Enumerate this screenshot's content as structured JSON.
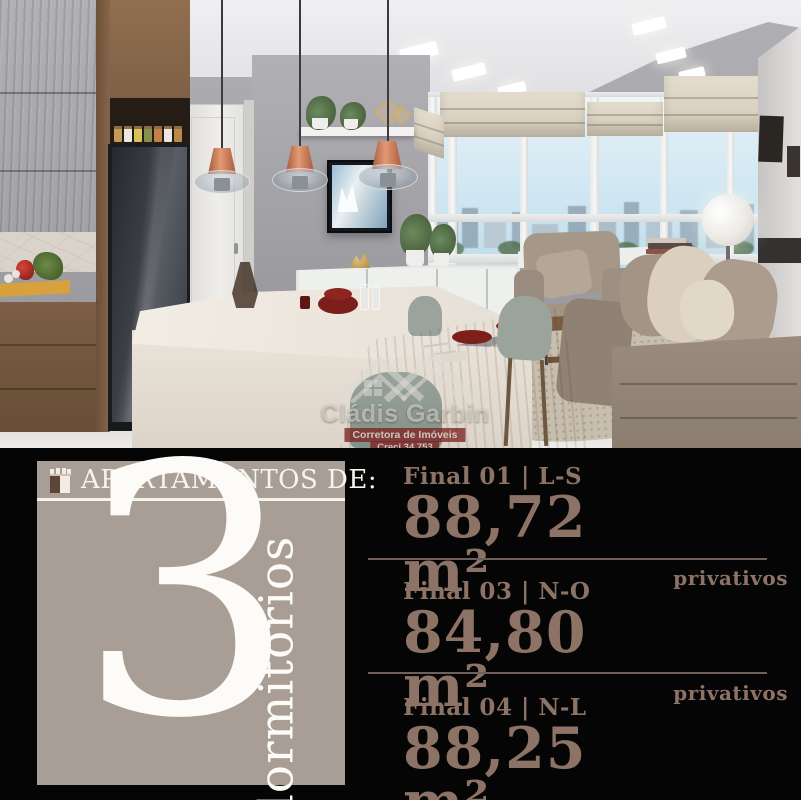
{
  "watermark": {
    "title": "Cládis Garbin",
    "subtitle": "Corretora de Imóveis",
    "creci": "Creci 34.753"
  },
  "left_panel": {
    "header": "APARTAMENTOS DE:",
    "number": "3",
    "number_label": "dormitórios"
  },
  "listings": [
    {
      "label": "Final 01 | L-S",
      "area": "88,72 m²",
      "qualifier": "privativos"
    },
    {
      "label": "Final 03 | N-O",
      "area": "84,80 m²",
      "qualifier": "privativos"
    },
    {
      "label": "Final 04 | N-L",
      "area": "88,25 m²",
      "qualifier": "privativos"
    }
  ],
  "colors": {
    "background": "#050505",
    "panel": "#a89e95",
    "panel_text": "#f7f4ee",
    "listing_text": "#8d7365",
    "divider": "#6f6159",
    "watermark_red": "#7c2422",
    "copper": "#c97c55"
  }
}
